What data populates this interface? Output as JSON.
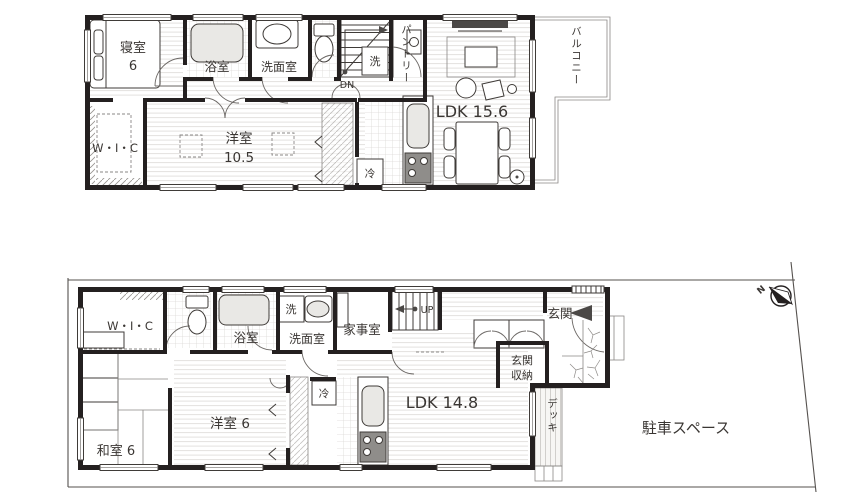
{
  "floor2": {
    "bedroom_l1": "寝室",
    "bedroom_l2": "6",
    "bath": "浴室",
    "washroom": "洗面室",
    "pantry": "パントリー",
    "washer": "洗",
    "stairs": "DN",
    "ldk": "LDK 15.6",
    "balcony": "バルコニー",
    "wic": "W・I・C",
    "western_l1": "洋室",
    "western_l2": "10.5",
    "fridge": "冷"
  },
  "floor1": {
    "wic": "W・I・C",
    "bath": "浴室",
    "washer": "洗",
    "washroom": "洗面室",
    "utility": "家事室",
    "stairs": "UP",
    "entrance": "玄関",
    "entrance_storage_l1": "玄関",
    "entrance_storage_l2": "収納",
    "japanese_room": "和室 6",
    "western_room": "洋室 6",
    "fridge": "冷",
    "ldk": "LDK 14.8",
    "deck": "デッキ"
  },
  "site": {
    "parking": "駐車スペース",
    "compass_north": "N"
  },
  "colors": {
    "wall": "#242020",
    "line": "#3f3b38",
    "floor_stripe": "#e3e1df",
    "background": "#ffffff"
  }
}
